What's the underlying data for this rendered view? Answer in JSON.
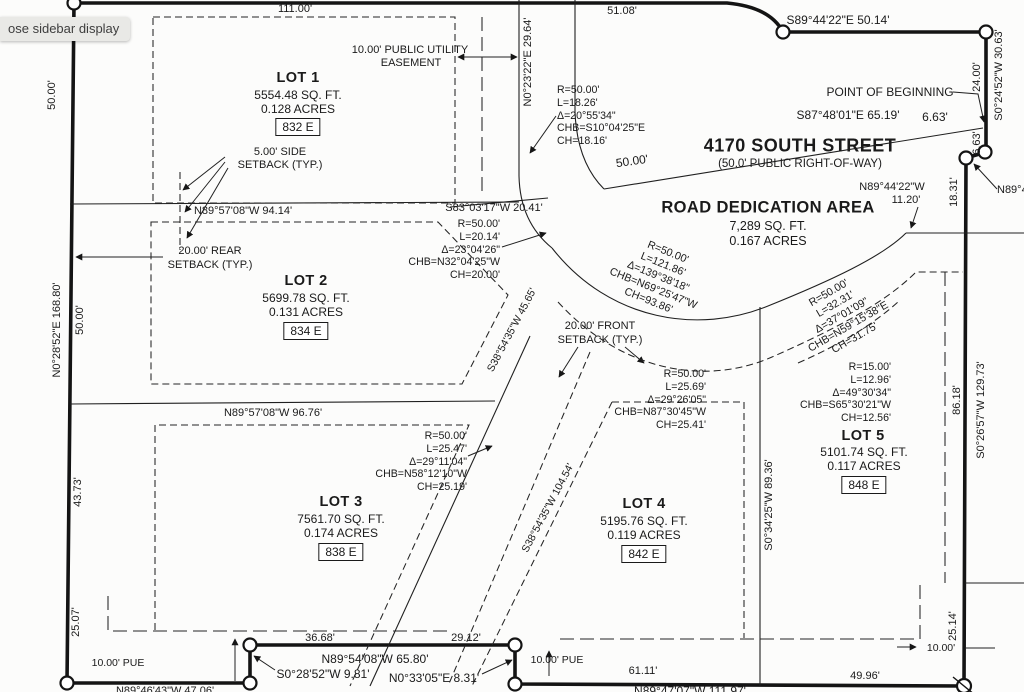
{
  "tooltip": {
    "text": "ose sidebar display"
  },
  "road": {
    "name": "4170 SOUTH STREET",
    "row": "(50.0' PUBLIC RIGHT-OF-WAY)"
  },
  "dedication": {
    "title": "ROAD DEDICATION AREA",
    "sqft": "7,289 SQ. FT.",
    "acres": "0.167 ACRES"
  },
  "pob": {
    "label": "POINT OF BEGINNING"
  },
  "lots": [
    {
      "name": "LOT 1",
      "sqft": "5554.48 SQ. FT.",
      "acres": "0.128 ACRES",
      "address": "832 E"
    },
    {
      "name": "LOT 2",
      "sqft": "5699.78 SQ. FT.",
      "acres": "0.131 ACRES",
      "address": "834 E"
    },
    {
      "name": "LOT 3",
      "sqft": "7561.70 SQ. FT.",
      "acres": "0.174 ACRES",
      "address": "838 E"
    },
    {
      "name": "LOT 4",
      "sqft": "5195.76 SQ. FT.",
      "acres": "0.119 ACRES",
      "address": "842 E"
    },
    {
      "name": "LOT 5",
      "sqft": "5101.74 SQ. FT.",
      "acres": "0.117 ACRES",
      "address": "848 E"
    }
  ],
  "setbacks": {
    "side": {
      "line1": "5.00' SIDE",
      "line2": "SETBACK (TYP.)"
    },
    "rear": {
      "line1": "20.00' REAR",
      "line2": "SETBACK (TYP.)"
    },
    "front": {
      "line1": "20.00' FRONT",
      "line2": "SETBACK (TYP.)"
    }
  },
  "easements": {
    "pue_main_line1": "10.00' PUBLIC UTILITY",
    "pue_main_line2": "EASEMENT",
    "pue_bottom_left": "10.00' PUE",
    "pue_bottom_center": "10.00' PUE",
    "pue_bottom_right": "10.00'"
  },
  "curves": {
    "c1": {
      "r": "R=50.00'",
      "l": "L=18.26'",
      "d": "Δ=20°55'34\"",
      "chb": "CHB=S10°04'25\"E",
      "ch": "CH=18.16'"
    },
    "c2": {
      "r": "R=50.00'",
      "l": "L=20.14'",
      "d": "Δ=23°04'26\"",
      "chb": "CHB=N32°04'25\"W",
      "ch": "CH=20.00'"
    },
    "c3": {
      "r": "R=50.00'",
      "l": "L=121.86'",
      "d": "Δ=139°38'18\"",
      "chb": "CHB=N69°25'47\"W",
      "ch": "CH=93.86'"
    },
    "c4": {
      "r": "R=50.00'",
      "l": "L=32.31'",
      "d": "Δ=37°01'09\"",
      "chb": "CHB=N59°15'38\"E",
      "ch": "CH=31.75'"
    },
    "c5": {
      "r": "R=50.00'",
      "l": "L=25.47'",
      "d": "Δ=29°11'04\"",
      "chb": "CHB=N58°12'10\"W",
      "ch": "CH=25.19'"
    },
    "c6": {
      "r": "R=50.00'",
      "l": "L=25.69'",
      "d": "Δ=29°26'05\"",
      "chb": "CHB=N87°30'45\"W",
      "ch": "CH=25.41'"
    },
    "c7": {
      "r": "R=15.00'",
      "l": "L=12.96'",
      "d": "Δ=49°30'34\"",
      "chb": "CHB=S65°30'21\"W",
      "ch": "CH=12.56'"
    }
  },
  "dims": {
    "top_left": "111.00'",
    "top_right": "51.08'",
    "ne_bearing": "S89°44'22\"E  50.14'",
    "east_24": "24.00'",
    "east_main": "S0°24'52\"W  30.63'",
    "east_663_v": "6.63'",
    "east_663_h": "6.63'",
    "east_1831": "18.31'",
    "east_clip": "N89°4",
    "pob_bearing": "S87°48'01\"E  65.19'",
    "n894422": "N89°44'22\"W",
    "n894422_d": "11.20'",
    "east_lower": "S0°26'57\"W  129.73'",
    "east_8618": "86.18'",
    "east_2514": "25.14'",
    "west_50_top": "50.00'",
    "west_main": "N0°28'52\"E  168.80'",
    "west_50_mid": "50.00'",
    "west_4373": "43.73'",
    "west_2507": "25.07'",
    "road_n0": "N0°23'22\"E  29.64'",
    "road_50": "50.00'",
    "lot12": "N89°57'08\"W  94.14'",
    "lot23": "N89°57'08\"W  96.76'",
    "s830317": "S83°03'17\"W  20.41'",
    "s4565": "S38°54'35\"W  45.65'",
    "s10454": "S38°54'35\"W  104.54'",
    "s03425": "S0°34'25\"W  89.36'",
    "b_3668": "36.68'",
    "b_2912": "29.12'",
    "b_n895408": "N89°54'08\"W  65.80'",
    "b_s02852": "S0°28'52\"W  9.81'",
    "b_n03305": "N0°33'05\"E  8.31'",
    "b_6111": "61.11'",
    "b_4996": "49.96'",
    "b_clip_center": "N89°47'07\"W  111.97'",
    "b_clip_left": "N89°46'43\"W  47.06'"
  }
}
